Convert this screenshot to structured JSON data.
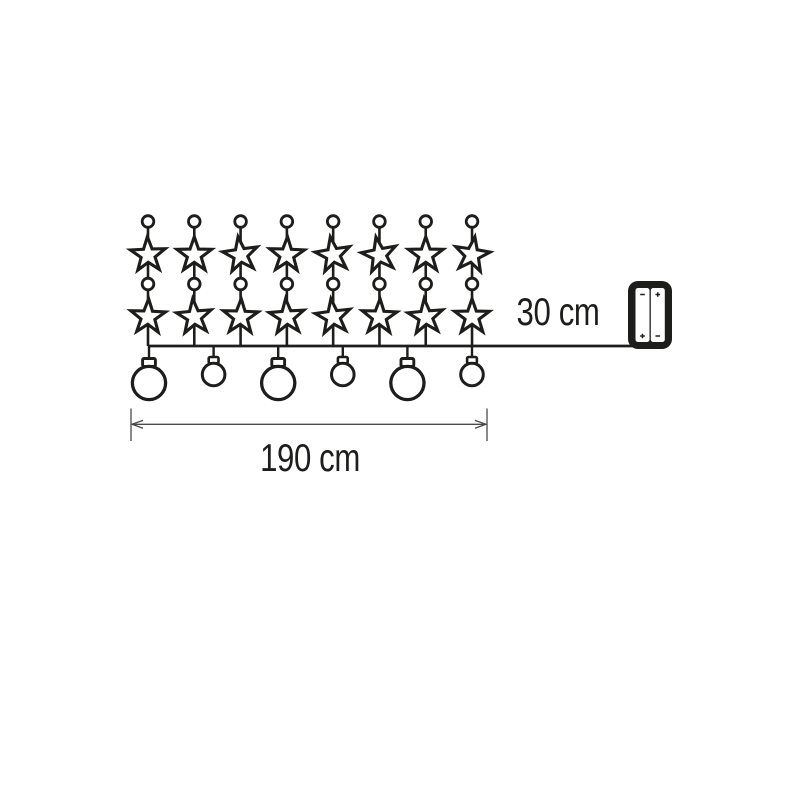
{
  "page": {
    "background_color": "#ffffff"
  },
  "diagram": {
    "title": "Star and ball light chain dimension diagram",
    "ink_color": "#1d1d1b",
    "dimension_color": "#4a4a4a",
    "strands": {
      "count": 8,
      "ornament_sequence": [
        "connector-bead",
        "star",
        "connector-bead",
        "star"
      ]
    },
    "balls": {
      "pattern": [
        "large",
        "small",
        "large",
        "small",
        "large",
        "small"
      ]
    },
    "battery_box": {
      "cells": [
        {
          "top_mark": "-",
          "bottom_mark": "+"
        },
        {
          "top_mark": "+",
          "bottom_mark": "-"
        }
      ]
    },
    "labels": {
      "lead_length": "30 cm",
      "chain_length": "190 cm"
    }
  }
}
